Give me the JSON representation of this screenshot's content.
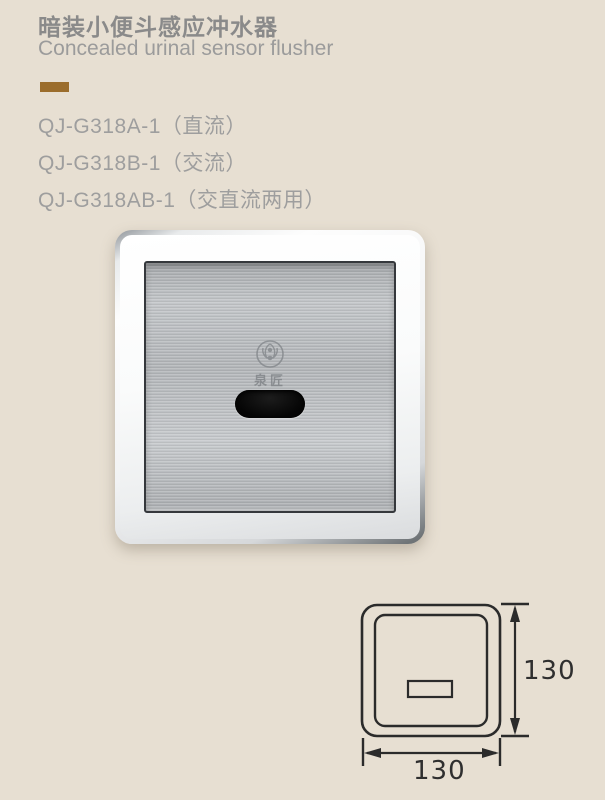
{
  "header": {
    "title_zh": "暗装小便斗感应冲水器",
    "title_en": "Concealed urinal sensor flusher"
  },
  "models": [
    {
      "label": "QJ-G318A-1（直流）"
    },
    {
      "label": "QJ-G318B-1（交流）"
    },
    {
      "label": "QJ-G318AB-1（交直流两用）"
    }
  ],
  "product": {
    "name": "Concealed urinal sensor flusher panel",
    "logo_zh": "泉匠",
    "logo_en": "QUANJIANG"
  },
  "dimensions": {
    "height_label": "130",
    "width_label": "130"
  },
  "colors": {
    "background": "#e7dfd2",
    "title_gray": "#8a8a8a",
    "subtitle_gray": "#9b9b9b",
    "model_gray": "#9e9e9e",
    "accent_brown": "#9b6d2c",
    "drawing_line": "#2b2b2b",
    "sensor_black": "#0a0a0a"
  }
}
